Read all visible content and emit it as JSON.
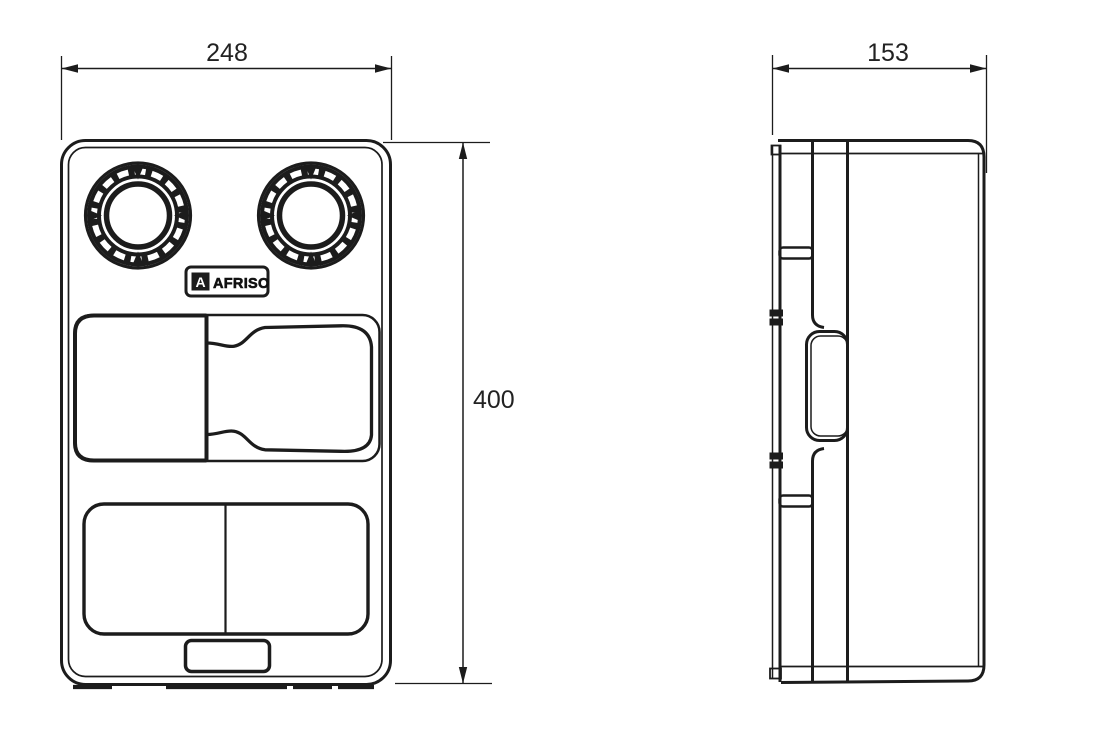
{
  "dimensions": {
    "front_width_mm": "248",
    "front_height_mm": "400",
    "side_depth_mm": "153"
  },
  "logo": {
    "text": "AFRISO",
    "mark_letter": "A"
  },
  "colors": {
    "line": "#1c1c1c",
    "text": "#222222",
    "background": "#ffffff"
  }
}
